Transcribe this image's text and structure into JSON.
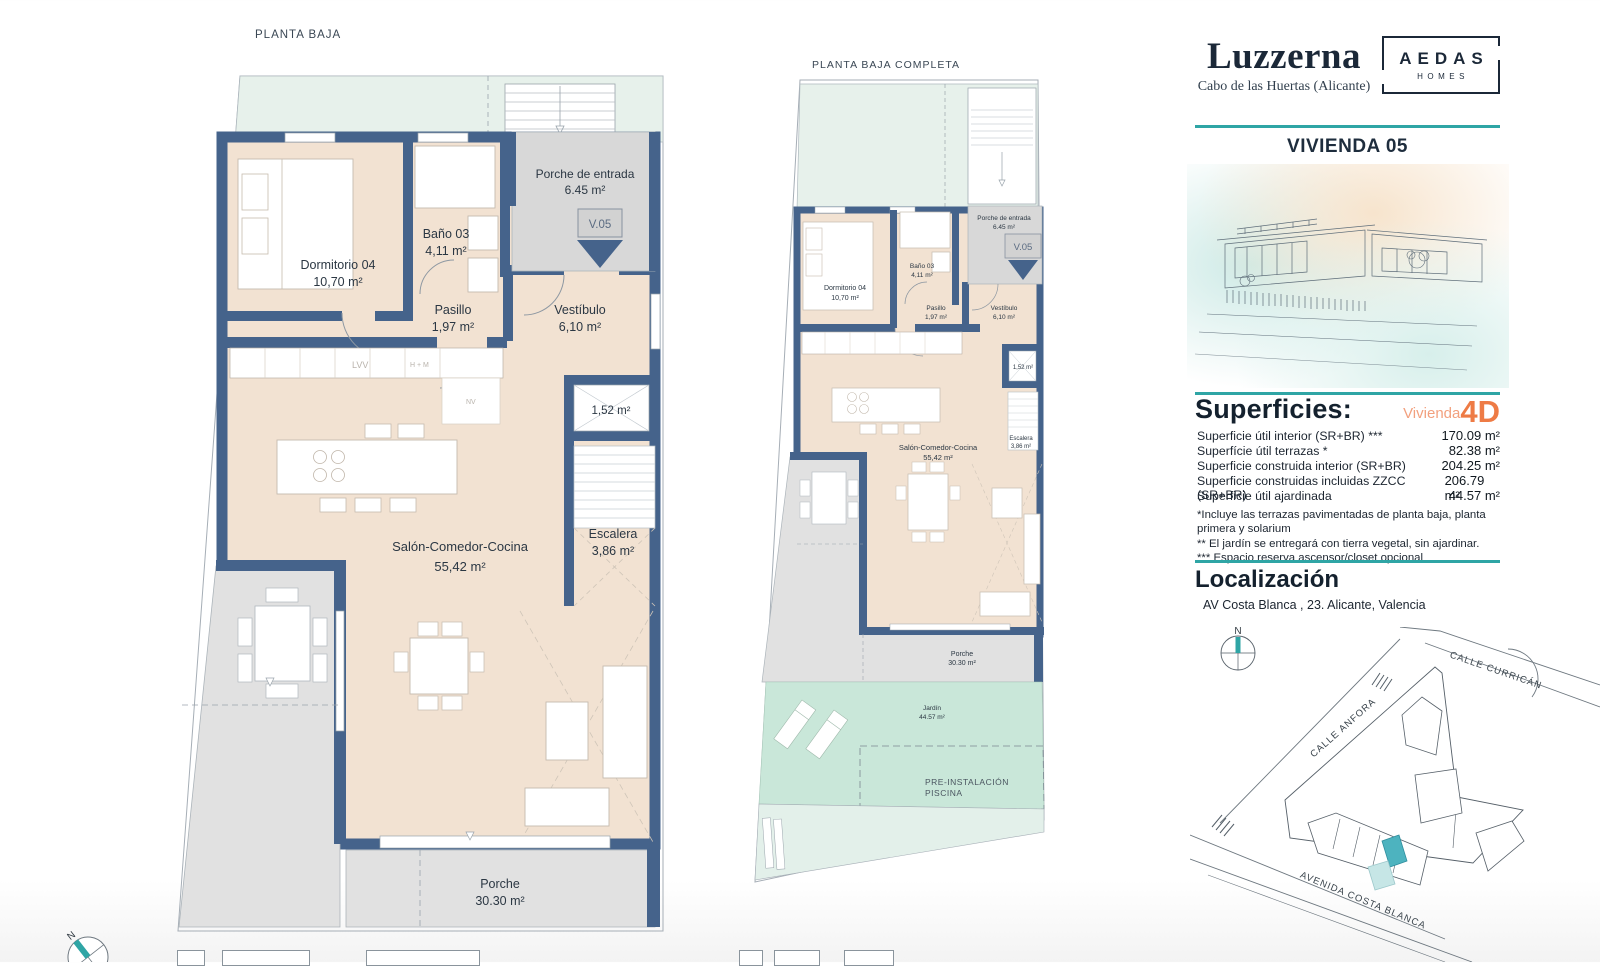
{
  "panel": {
    "brand": {
      "title": "Luzzerna",
      "subtitle": "Cabo de las Huertas (Alicante)",
      "logo_top": "AEDAS",
      "logo_bottom": "HOMES"
    },
    "vivienda": "VIVIENDA 05",
    "superficies": {
      "heading": "Superficies:",
      "vivienda_label": "Vivienda",
      "vivienda_type": "4D",
      "rows": [
        {
          "label": "Superficie útil interior (SR+BR) ***",
          "value": "170.09 m²"
        },
        {
          "label": "Superfície útil terrazas *",
          "value": "82.38 m²"
        },
        {
          "label": "Superficie construida interior (SR+BR)",
          "value": "204.25 m²"
        },
        {
          "label": "Superficie construidas incluidas ZZCC (SR+BR)",
          "value": "206.79 m²"
        },
        {
          "label": "Superficie útil ajardinada",
          "value": "44.57 m²"
        }
      ],
      "notes": [
        "*Incluye las terrazas pavimentadas de planta baja, planta primera y solarium",
        "** El jardín se entregará con tierra vegetal, sin ajardinar.",
        "*** Espacio reserva ascensor/closet opcional"
      ]
    },
    "localizacion": {
      "heading": "Localización",
      "address": "AV Costa Blanca , 23. Alicante, Valencia"
    }
  },
  "map": {
    "north": "N",
    "streets": {
      "anfora": "CALLE ANFORA",
      "curricane": "CALLE CURRICÁN",
      "avenida": "AVENIDA COSTA BLANCA"
    }
  },
  "compass": {
    "north": "N"
  },
  "plan_left": {
    "title": "PLANTA BAJA",
    "unit": "V.05",
    "kitchen": [
      "LVV",
      "H + M",
      "NV"
    ],
    "rooms": {
      "porche_entrada": {
        "name": "Porche de entrada",
        "area": "6.45 m²"
      },
      "dormitorio": {
        "name": "Dormitorio 04",
        "area": "10,70 m²"
      },
      "bano": {
        "name": "Baño 03",
        "area": "4,11 m²"
      },
      "pasillo": {
        "name": "Pasillo",
        "area": "1,97 m²"
      },
      "vestibulo": {
        "name": "Vestíbulo",
        "area": "6,10 m²"
      },
      "shaft": {
        "area": "1,52 m²"
      },
      "salon": {
        "name": "Salón-Comedor-Cocina",
        "area": "55,42 m²"
      },
      "escalera": {
        "name": "Escalera",
        "area": "3,86 m²"
      },
      "porche": {
        "name": "Porche",
        "area": "30.30 m²"
      }
    }
  },
  "plan_mid": {
    "title": "PLANTA BAJA COMPLETA",
    "unit": "V.05",
    "rooms": {
      "porche_entrada": {
        "name": "Porche de entrada",
        "area": "6.45 m²"
      },
      "dormitorio": {
        "name": "Dormitorio 04",
        "area": "10,70 m²"
      },
      "bano": {
        "name": "Baño 03",
        "area": "4,11 m²"
      },
      "pasillo": {
        "name": "Pasillo",
        "area": "1,97 m²"
      },
      "vestibulo": {
        "name": "Vestíbulo",
        "area": "6,10 m²"
      },
      "shaft": {
        "area": "1,52 m²"
      },
      "salon": {
        "name": "Salón-Comedor-Cocina",
        "area": "55,42 m²"
      },
      "escalera": {
        "name": "Escalera",
        "area": "3,86 m²"
      },
      "porche": {
        "name": "Porche",
        "area": "30.30 m²"
      },
      "jardin": {
        "name": "Jardín",
        "area": "44.57 m²"
      },
      "piscina": {
        "line1": "PRE-INSTALACIÓN",
        "line2": "PISCINA"
      }
    }
  },
  "colors": {
    "teal": "#2fa5a5",
    "orange": "#ee7b45",
    "orange_light": "#f2a07e",
    "navy_wall": "#45638b",
    "floor_beige": "#f2e2d2",
    "terrace_mint": "#e7f1eb",
    "garden_mint": "#c9e7d9",
    "porch_gray": "#e1e1e1",
    "highlight_plot": "#4db3bf"
  }
}
